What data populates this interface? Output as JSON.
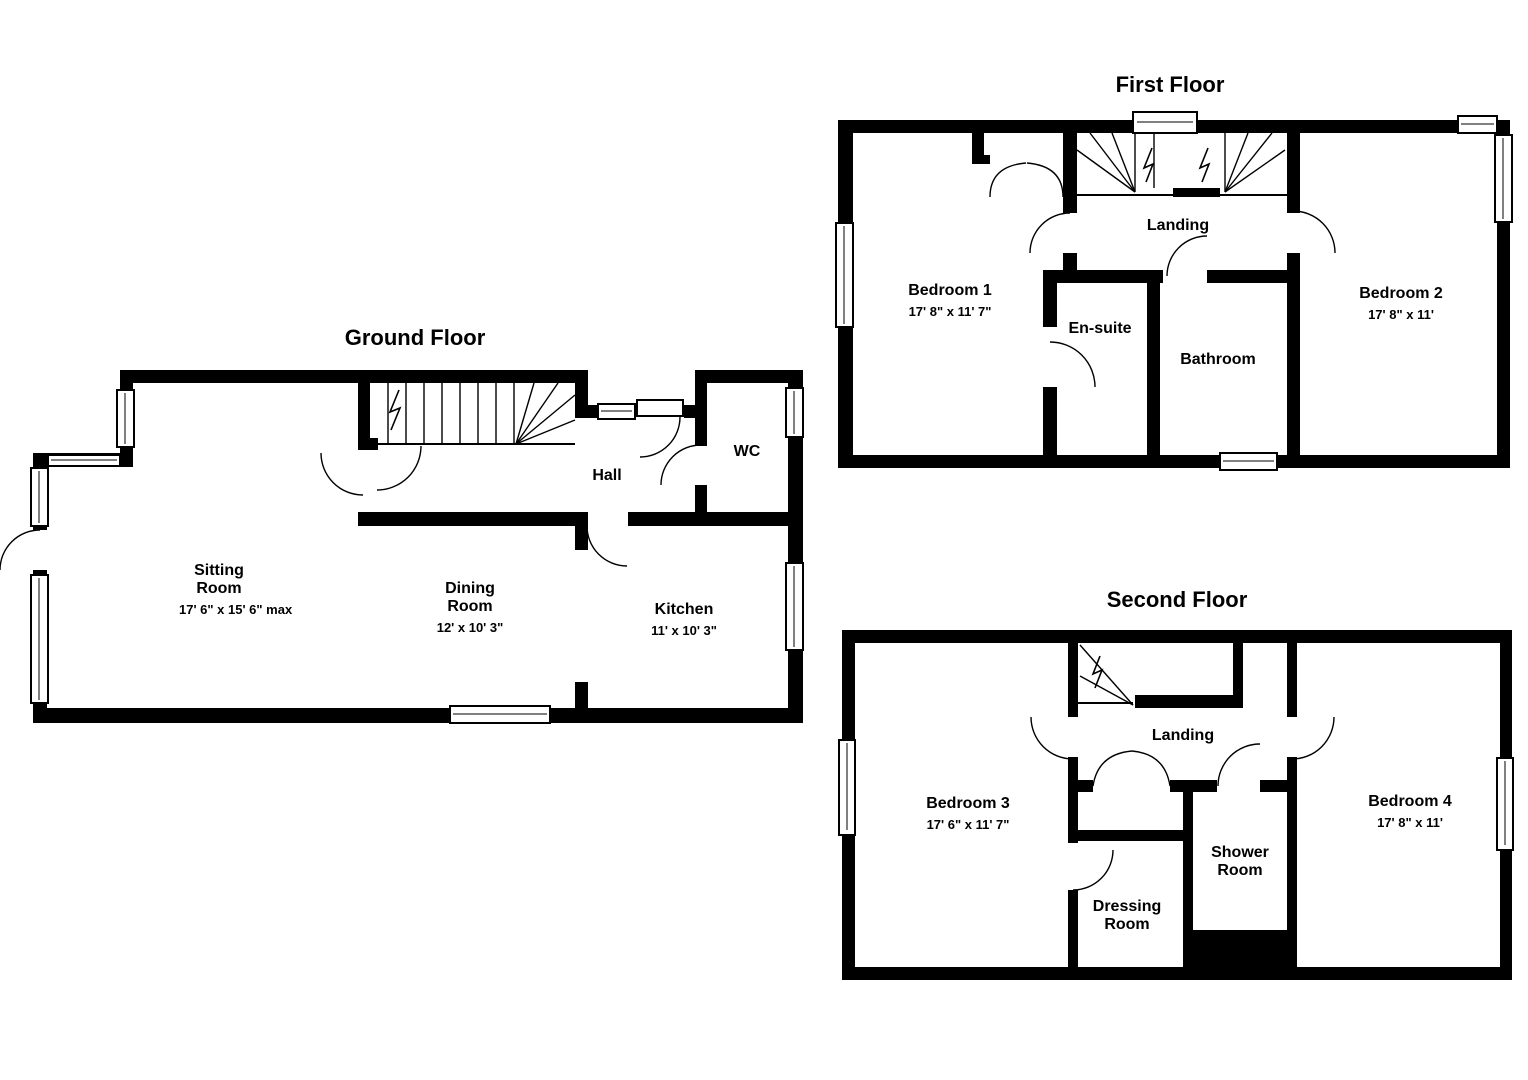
{
  "page": {
    "background": "#ffffff",
    "wall_color": "#000000",
    "line_color": "#000000"
  },
  "floors": [
    {
      "id": "ground",
      "title": "Ground Floor",
      "rooms": [
        {
          "name": "Sitting Room",
          "dims": "17' 6\" x 15' 6\" max"
        },
        {
          "name": "Dining Room",
          "dims": "12' x 10' 3\""
        },
        {
          "name": "Kitchen",
          "dims": "11' x 10' 3\""
        },
        {
          "name": "Hall"
        },
        {
          "name": "WC"
        }
      ]
    },
    {
      "id": "first",
      "title": "First Floor",
      "rooms": [
        {
          "name": "Bedroom 1",
          "dims": "17' 8\" x 11' 7\""
        },
        {
          "name": "En-suite"
        },
        {
          "name": "Bathroom"
        },
        {
          "name": "Bedroom 2",
          "dims": "17' 8\" x 11'"
        },
        {
          "name": "Landing"
        }
      ]
    },
    {
      "id": "second",
      "title": "Second Floor",
      "rooms": [
        {
          "name": "Bedroom 3",
          "dims": "17' 6\" x 11' 7\""
        },
        {
          "name": "Dressing Room"
        },
        {
          "name": "Shower Room"
        },
        {
          "name": "Bedroom 4",
          "dims": "17' 8\" x 11'"
        },
        {
          "name": "Landing"
        }
      ]
    }
  ]
}
